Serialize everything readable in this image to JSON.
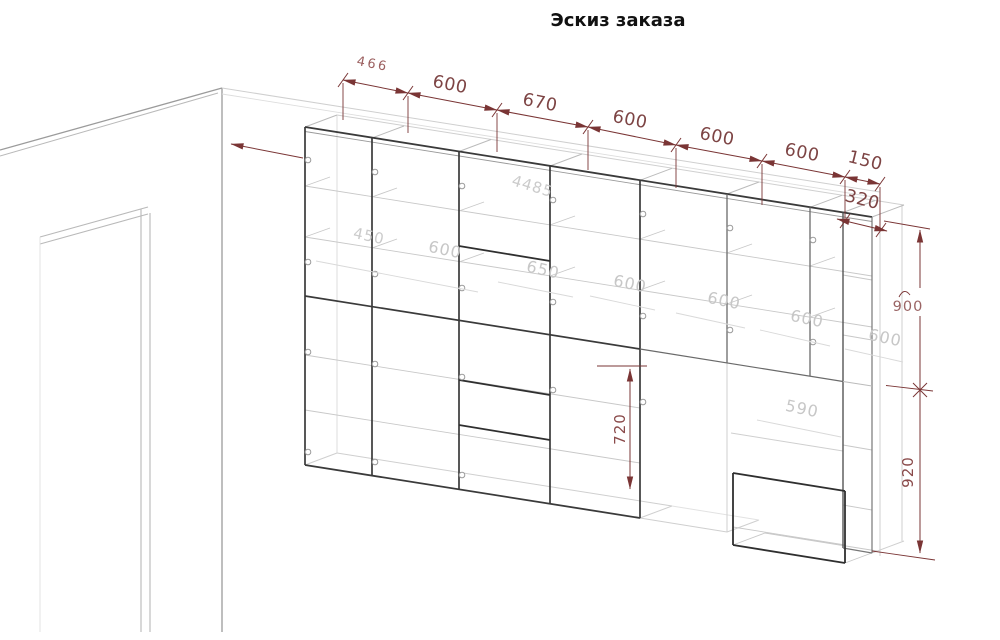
{
  "title": "Эскиз заказа",
  "colors": {
    "dimension_line": "#7a3535",
    "dimension_text": "#7d4444",
    "faint_dimension": "#c7c7c7",
    "cabinet_edge_dark": "#3a3a3a",
    "cabinet_edge_light": "#cfcfcf",
    "wall_line": "#9b9b9b"
  },
  "dimensions": {
    "top_chain": [
      "466",
      "600",
      "670",
      "600",
      "600",
      "600",
      "150"
    ],
    "depth": "320",
    "right_upper_height": "900",
    "right_lower_height": "920",
    "middle_vertical": "720"
  },
  "faint_dims": [
    "450",
    "600",
    "4485",
    "650",
    "600",
    "600",
    "600",
    "600",
    "590"
  ]
}
